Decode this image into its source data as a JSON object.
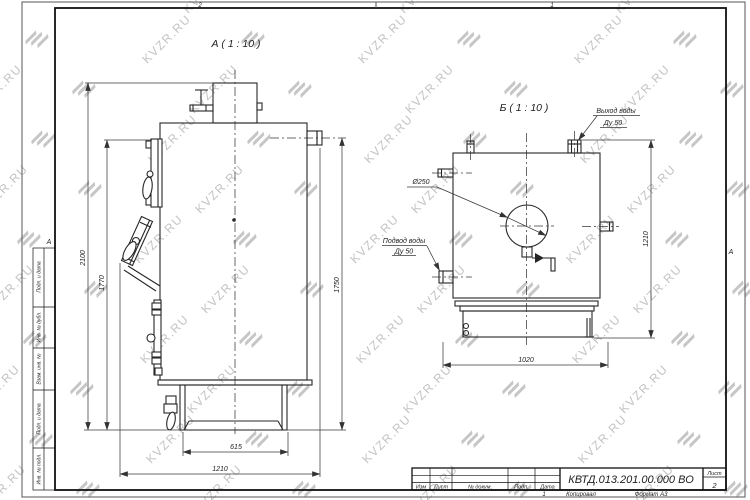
{
  "watermark": {
    "text": "KVZR.RU"
  },
  "frame": {
    "zone_top_left": "2",
    "zone_top_right": "1",
    "zone_letter_left": "А",
    "zone_letter_right": "А",
    "side_column_labels": [
      "Подп. и дата",
      "Инв. № дубл.",
      "Взам. инв. №",
      "Подп. и дата",
      "Инв. № подл."
    ]
  },
  "title_block": {
    "col_izm": "Изм",
    "col_list": "Лист",
    "col_dokum": "№ докум.",
    "col_podp": "Подп.",
    "col_data": "Дата",
    "doc_number": "КВТД.013.201.00.000 ВО",
    "sheet_label": "Лист",
    "sheet_number": "2",
    "footer_number": "1",
    "footer_copied": "Копировал",
    "footer_format": "Формат А3"
  },
  "view_a": {
    "label": "А ( 1 : 10 )",
    "dim_height_overall": "2100",
    "dim_height_body": "1770",
    "dim_height_outlet": "1750",
    "dim_base_width": "615",
    "dim_depth_overall": "1210"
  },
  "view_b": {
    "label": "Б ( 1 : 10 )",
    "outlet_label_line1": "Выход воды",
    "outlet_label_line2": "Ду 50",
    "inlet_label_line1": "Подвод воды",
    "inlet_label_line2": "Ду 50",
    "diameter_label": "Ø250",
    "dim_height": "1210",
    "dim_width": "1020"
  }
}
